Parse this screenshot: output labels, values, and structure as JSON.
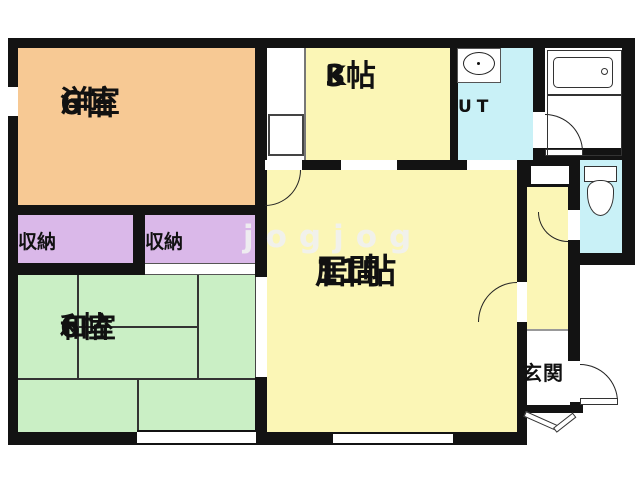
{
  "document": {
    "type": "apartment-floor-plan",
    "watermark": "jogjog"
  },
  "rooms": {
    "western_room": {
      "label": "洋室",
      "size": "6帖"
    },
    "kitchen": {
      "label": "K",
      "size": "3帖"
    },
    "utility": {
      "label": "UT"
    },
    "living": {
      "label": "居間",
      "size": "11帖"
    },
    "tatami_room": {
      "label": "和室",
      "size": "6帖"
    },
    "closet_left": {
      "label": "収納"
    },
    "closet_right": {
      "label": "収納"
    },
    "entrance": {
      "label": "玄関"
    }
  },
  "fixtures": {
    "bathtub": "bathtub-icon",
    "washbasin": "washbasin-icon",
    "toilet": "toilet-icon",
    "refrigerator": "refrigerator-box-icon",
    "entrance_step": "entrance-step-icon"
  },
  "colors": {
    "wall": "#131313",
    "western_room_fill": "#F7C994",
    "main_room_fill": "#FBF6B6",
    "tatami_fill": "#CAEFC5",
    "closet_fill": "#DAB8E9",
    "water_room_fill": "#C9F1F7",
    "watermark_color": "#F0F0F0"
  }
}
